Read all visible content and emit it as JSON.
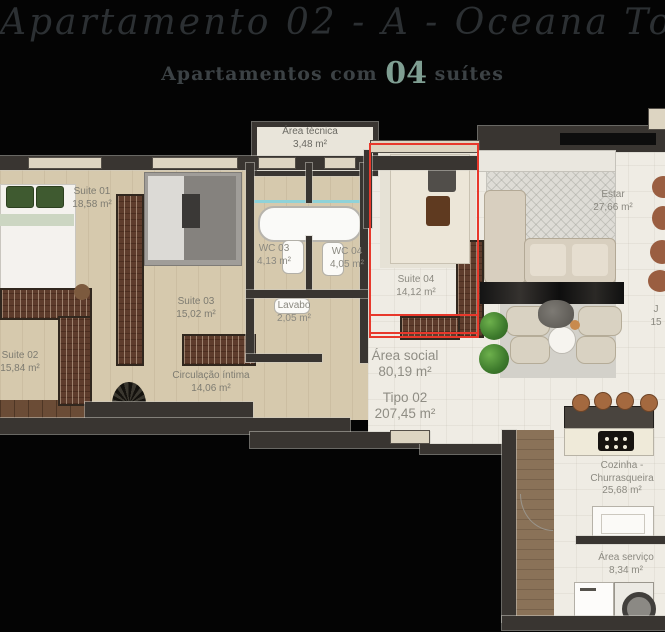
{
  "header": {
    "script_title": "Apartamento 02 - A - Oceana Tower",
    "subtitle": {
      "prefix": "Apartamentos com",
      "number": "04",
      "suffix": "suítes"
    },
    "accent_color": "#7f9e92"
  },
  "plan": {
    "highlight_color": "#e8382b",
    "rooms": [
      {
        "label": "Suite 01",
        "area": "18,58 m²"
      },
      {
        "label": "Suite 02",
        "area": "15,84 m²"
      },
      {
        "label": "Suite 03",
        "area": "15,02 m²"
      },
      {
        "label": "Suite 04",
        "area": "14,12 m²"
      },
      {
        "label": "Área técnica",
        "area": "3,48 m²"
      },
      {
        "label": "WC 03",
        "area": "4,13 m²"
      },
      {
        "label": "WC 04",
        "area": "4,05 m²"
      },
      {
        "label": "Lavabo",
        "area": "2,05 m²"
      },
      {
        "label": "Circulação íntima",
        "area": "14,06 m²"
      },
      {
        "label": "Estar",
        "area": "27,66 m²"
      },
      {
        "label": "Área social",
        "area": "80,19 m²"
      },
      {
        "label": "Tipo 02",
        "area": "207,45 m²"
      },
      {
        "label": "Cozinha - Churrasqueira",
        "area": "25,68 m²"
      },
      {
        "label": "Área serviço",
        "area": "8,34 m²"
      }
    ],
    "edge_fragment": {
      "label": "J",
      "area": "15"
    }
  }
}
